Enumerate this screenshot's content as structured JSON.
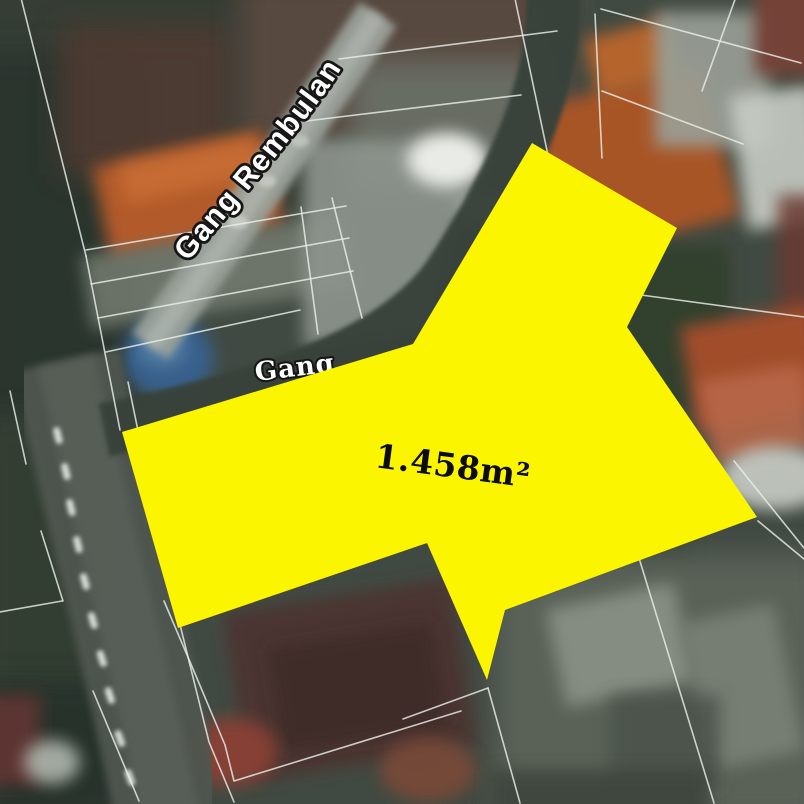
{
  "plot": {
    "area_label": "1.458m²",
    "fill_color": "#FCF500",
    "points": "532,143 677,228 627,327 757,517 505,610 487,680 427,543 178,628 122,432 413,344"
  },
  "road_labels": {
    "rembulan": "Gang Rembulan",
    "gang": "Gang"
  },
  "palette": {
    "highlight_yellow": "#FCF500",
    "label_fill": "#ffffff",
    "label_outline": "#161616",
    "area_text": "#0c0c0c",
    "parcel_line": "#e9eee9",
    "road_dark": "#39423a",
    "road_light": "#99a099",
    "base_terrain": "#414a42"
  }
}
